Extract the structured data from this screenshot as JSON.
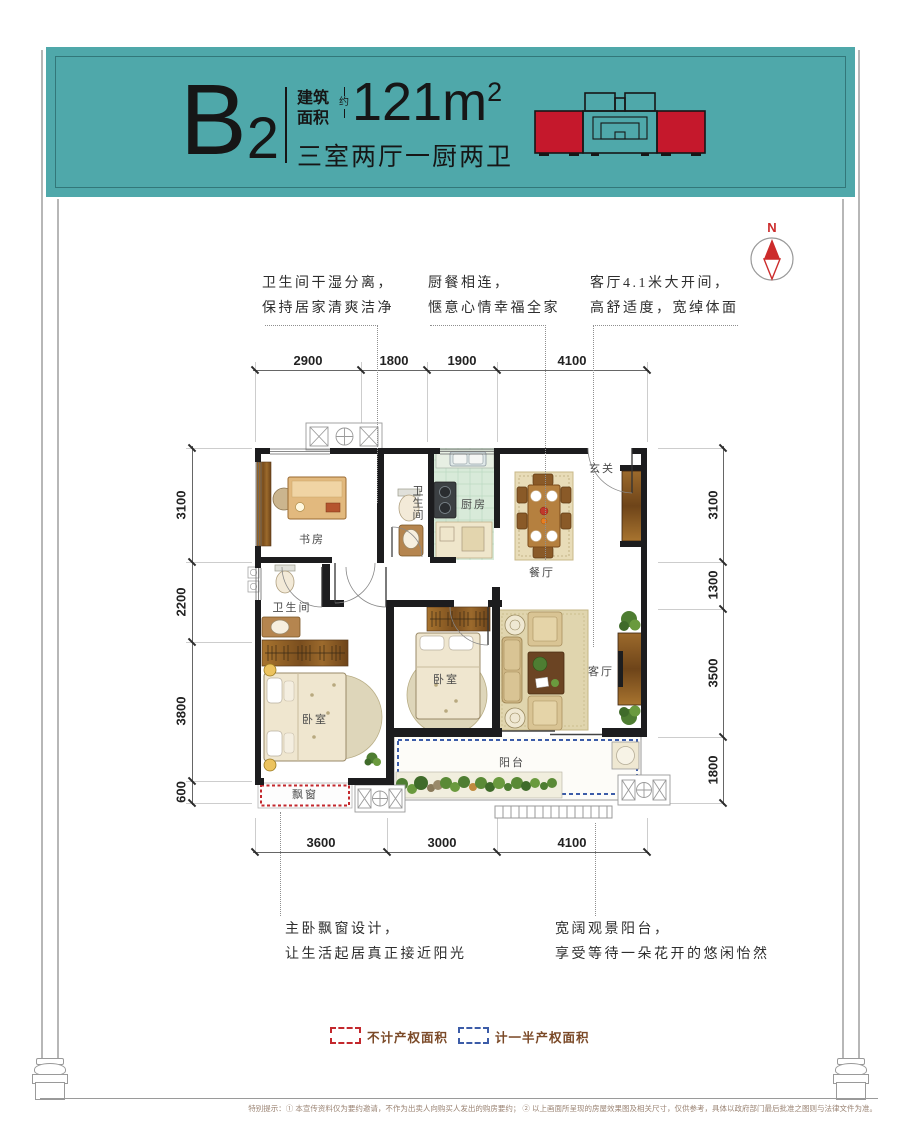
{
  "header": {
    "unit": "B",
    "unit_sub": "2",
    "area_label_1": "建筑",
    "area_label_2": "面积",
    "approx": "约",
    "area_value": "121m",
    "area_exp": "2",
    "spec": "三室两厅一厨两卫",
    "teal": "#4FA8AA",
    "highlight_red": "#C5182C"
  },
  "compass": {
    "north": "N"
  },
  "callouts_top": [
    {
      "line1": "卫生间干湿分离，",
      "line2": "保持居家清爽洁净"
    },
    {
      "line1": "厨餐相连，",
      "line2": "惬意心情幸福全家"
    },
    {
      "line1": "客厅4.1米大开间，",
      "line2": "高舒适度，宽绰体面"
    }
  ],
  "callouts_bottom": [
    {
      "line1": "主卧飘窗设计，",
      "line2": "让生活起居真正接近阳光"
    },
    {
      "line1": "宽阔观景阳台，",
      "line2": "享受等待一朵花开的悠闲怡然"
    }
  ],
  "dims": {
    "top": [
      "2900",
      "1800",
      "1900",
      "4100"
    ],
    "bottom": [
      "3600",
      "3000",
      "4100"
    ],
    "left": [
      "3100",
      "2200",
      "3800",
      "600"
    ],
    "right": [
      "3100",
      "1300",
      "3500",
      "1800"
    ]
  },
  "plan": {
    "study": "书房",
    "bath_top": "卫生间",
    "kitchen": "厨房",
    "dining": "餐厅",
    "foyer": "玄关",
    "bath_left": "卫生间",
    "bedroom_master": "卧室",
    "bedroom_second": "卧室",
    "living": "客厅",
    "balcony": "阳台",
    "bay_window": "飘窗"
  },
  "legend": {
    "items": [
      {
        "label": "不计产权面积",
        "color": "#C3282D"
      },
      {
        "label": "计一半产权面积",
        "color": "#3C5CA8"
      }
    ]
  },
  "footer": {
    "disclaimer": "特别提示：① 本宣传资料仅为要约邀请，不作为出卖人向购买人发出的购房要约； ② 以上画面所呈现的房屋效果图及相关尺寸，仅供参考，具体以政府部门最后批准之图则与法律文件为准。"
  }
}
